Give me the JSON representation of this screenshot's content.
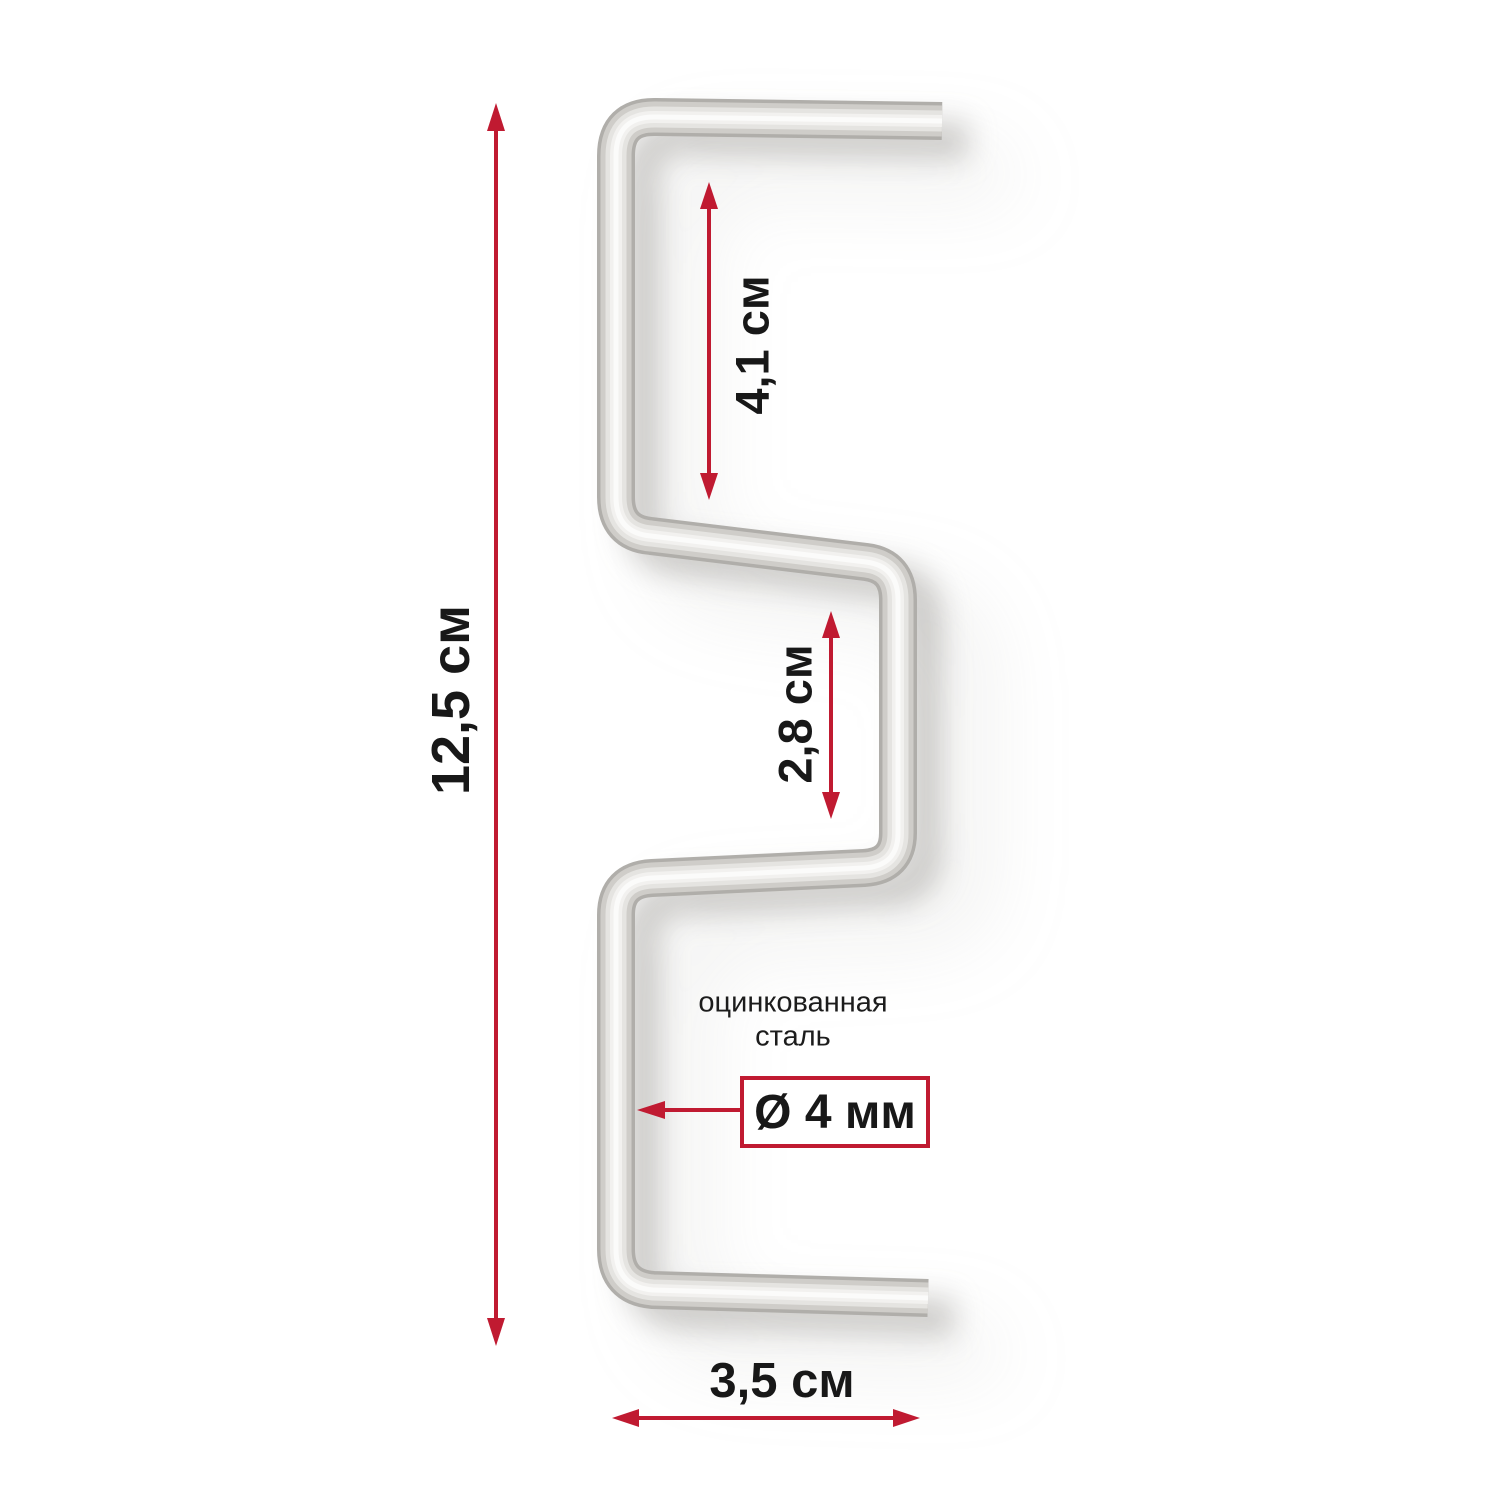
{
  "diagram": {
    "labels": {
      "total_height": "12,5 см",
      "upper_gap": "4,1 см",
      "middle_gap": "2,8 см",
      "bottom_width": "3,5 см",
      "diameter": "Ø 4 мм",
      "material_line1": "оцинкованная",
      "material_line2": "сталь"
    },
    "colors": {
      "accent_red": "#c01a31",
      "text": "#181818",
      "background": "#ffffff"
    }
  }
}
